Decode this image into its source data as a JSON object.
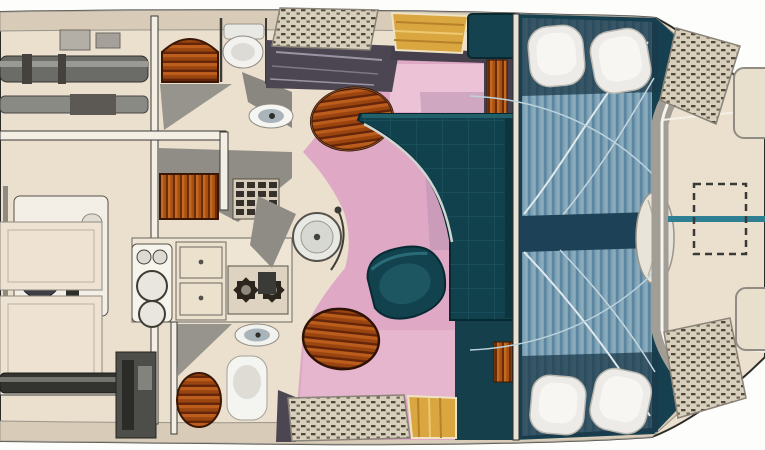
{
  "meta": {
    "title": "Motor yacht interior floor plan (top view, bow right)",
    "diagram_type": "floor-plan",
    "has_text": false
  },
  "colors": {
    "background_white": "#fdfdfc",
    "hull_fill": "#ebdfce",
    "hull_outline": "#2b2b28",
    "deck_band": "#d8cbb7",
    "deck_gray": "#a29e96",
    "wall_white": "#f4efe4",
    "carpet_pink": "#dfa9c5",
    "carpet_pink_light": "#ecc3d6",
    "carpet_mauve_shadow": "#b98fb0",
    "settee_teal": "#11414d",
    "settee_teal_light": "#226069",
    "cabin_teal_dark": "#16404f",
    "bed_blue": "#7fa2b5",
    "bed_stripe": "#5d86a0",
    "pillow_white": "#edebe7",
    "wood_orange": "#a8500f",
    "wood_dark": "#5a2608",
    "steps_gold": "#d9a640",
    "cane_weave": "#d9cfbd",
    "console_gray": "#4c4653",
    "machinery_gray": "#6b6b67",
    "machinery_dark": "#33332f",
    "fixture_white": "#f3f2ee",
    "basin_gray": "#a9b4ba",
    "accent_teal_line": "#2e7f92"
  },
  "regions": [
    {
      "id": "engine-room",
      "name": "engine room (aft, left)"
    },
    {
      "id": "head-top",
      "name": "port head with toilet, washbasin, arched wardrobe"
    },
    {
      "id": "vanity",
      "name": "vanity with louvered cabinet and vent grate"
    },
    {
      "id": "galley",
      "name": "galley with twin sinks, counters, two-burner stove"
    },
    {
      "id": "head-bottom",
      "name": "starboard head with toilet, washbasin, wardrobe"
    },
    {
      "id": "salon",
      "name": "salon with pink carpet, L-settee, armchair, two tables"
    },
    {
      "id": "helm-console",
      "name": "helm console / dashboard"
    },
    {
      "id": "companionways",
      "name": "two golden step flights port and starboard"
    },
    {
      "id": "forward-cabin",
      "name": "forward cabin with two blue striped berths"
    },
    {
      "id": "foredeck",
      "name": "foredeck with dashed anchor hatch and centerline"
    }
  ],
  "inventory": {
    "pillows": 4,
    "berths": 2,
    "stove_burners": 2,
    "sink_bowls": 2,
    "wash_basins": 2,
    "toilets": 2,
    "round_tables": 2,
    "step_flights": 2,
    "cane_locker_panels": 4,
    "engines": 2,
    "generator": 1
  }
}
